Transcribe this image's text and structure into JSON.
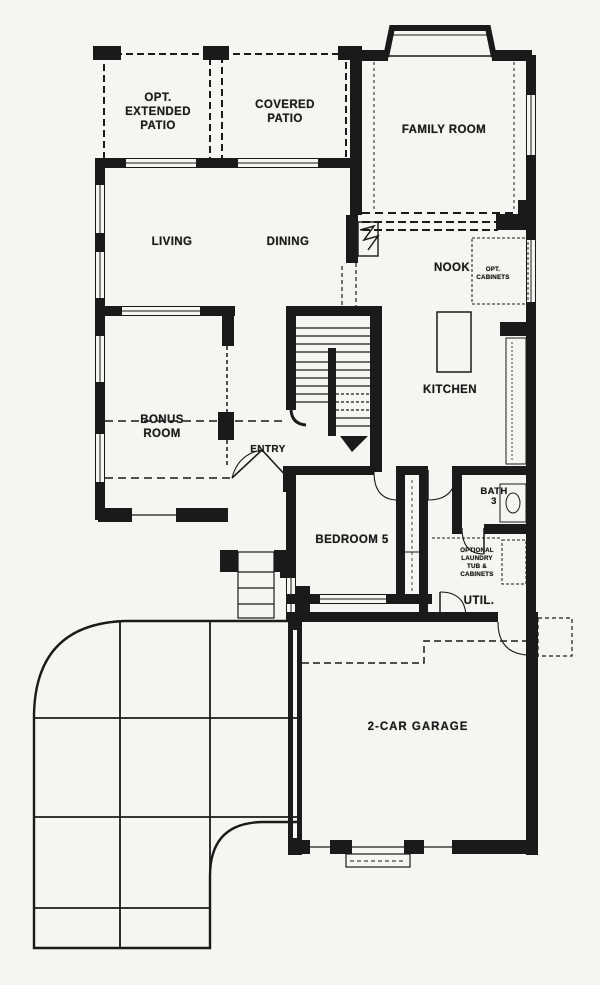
{
  "drawing": {
    "kind": "first-floor plan",
    "colors": {
      "ink": "#1a1a1a",
      "paper": "#f6f5f1"
    }
  },
  "labels": {
    "opt_extended_patio": "OPT.\nEXTENDED\nPATIO",
    "covered_patio": "COVERED\nPATIO",
    "family_room": "FAMILY ROOM",
    "living": "LIVING",
    "dining": "DINING",
    "nook": "NOOK",
    "opt_cabinets": "OPT.\nCABINETS",
    "kitchen": "KITCHEN",
    "bonus_room": "BONUS\nROOM",
    "entry": "ENTRY",
    "bedroom5": "BEDROOM 5",
    "bath3": "BATH\n3",
    "laundry_note": "OPTIONAL\nLAUNDRY\nTUB &\nCABINETS",
    "util": "UTIL.",
    "garage": "2-CAR GARAGE"
  }
}
